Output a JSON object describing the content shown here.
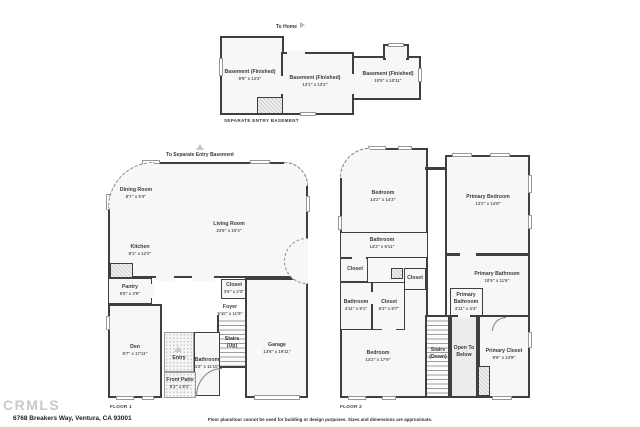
{
  "meta": {
    "logo": "CRMLS",
    "address": "6768 Breakers Way, Ventura, CA 93001",
    "disclaimer": "Floor plans/tour cannot be used for building or design purposes. Sizes and dimensions are approximate."
  },
  "colors": {
    "wall": "#3f3f3f",
    "room_fill": "#f7f7f7",
    "logo_gray": "#c5cacc"
  },
  "basement": {
    "caption": "SEPARATE ENTRY BASEMENT",
    "nav": "To Home",
    "rooms": [
      {
        "name": "Basement (Finished)",
        "dims": "8'9\" x 13'2\""
      },
      {
        "name": "Basement (Finished)",
        "dims": "13'1\" x 13'2\""
      },
      {
        "name": "Basement (Finished)",
        "dims": "10'5\" x 10'11\""
      }
    ]
  },
  "floor1": {
    "caption": "FLOOR 1",
    "nav": "To Separate Entry Basement",
    "rooms": [
      {
        "name": "Dining Room",
        "dims": "8'7\" x 9'3\""
      },
      {
        "name": "Living Room",
        "dims": "23'6\" x 19'3\""
      },
      {
        "name": "Kitchen",
        "dims": "8'1\" x 12'2\""
      },
      {
        "name": "Pantry",
        "dims": "5'8\" x 3'9\""
      },
      {
        "name": "Closet",
        "dims": "3'6\" x 2'3\""
      },
      {
        "name": "Foyer",
        "dims": "5'10\" x 11'9\""
      },
      {
        "name": "Den",
        "dims": "8'7\" x 17'11\""
      },
      {
        "name": "Stairs",
        "dims": "(Up)"
      },
      {
        "name": "Garage",
        "dims": "13'6\" x 19'11\""
      },
      {
        "name": "Bathroom",
        "dims": "4'2\" x 11'10\""
      },
      {
        "name": "Entry",
        "dims": ""
      },
      {
        "name": "Front Patio",
        "dims": "9'3\" x 8'1\""
      }
    ]
  },
  "floor2": {
    "caption": "FLOOR 2",
    "rooms": [
      {
        "name": "Bedroom",
        "dims": "14'2\" x 14'3\""
      },
      {
        "name": "Primary Bedroom",
        "dims": "13'2\" x 14'8\""
      },
      {
        "name": "Bathroom",
        "dims": "14'2\" x 6'11\""
      },
      {
        "name": "Closet",
        "dims": ""
      },
      {
        "name": "Closet",
        "dims": ""
      },
      {
        "name": "Bathroom",
        "dims": "4'11\" x 9'1\""
      },
      {
        "name": "Closet",
        "dims": "5'3\" x 8'7\""
      },
      {
        "name": "Primary Bathroom",
        "dims": "10'5\" x 11'6\""
      },
      {
        "name": "Primary Bathroom",
        "dims": "4'11\" x 4'4\""
      },
      {
        "name": "Bedroom",
        "dims": "14'2\" x 17'9\""
      },
      {
        "name": "Stairs",
        "dims": "(Down)"
      },
      {
        "name": "Open To Below",
        "dims": ""
      },
      {
        "name": "Primary Closet",
        "dims": "8'6\" x 13'9\""
      }
    ]
  }
}
